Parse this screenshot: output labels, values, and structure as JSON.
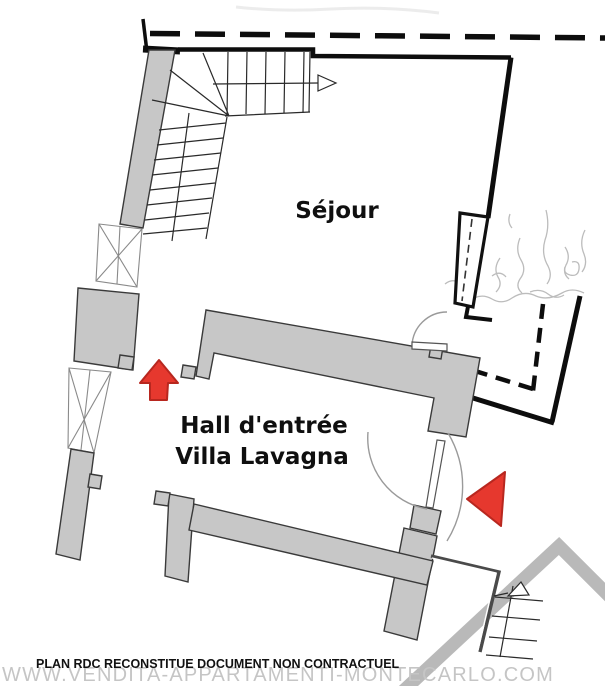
{
  "plan": {
    "rooms": {
      "sejour": {
        "label": "Séjour"
      },
      "hall": {
        "label_line1": "Hall d'entrée",
        "label_line2": "Villa Lavagna"
      }
    },
    "caption": "PLAN RDC RECONSTITUE  DOCUMENT NON CONTRACTUEL",
    "watermark": "WWW.VENDITA-APPARTAMENTI-MONTECARLO.COM",
    "colors": {
      "wall_fill": "#c7c7c7",
      "wall_outline": "#3a3a3a",
      "line_black": "#0d0d0d",
      "arrow_red_fill": "#e6382e",
      "arrow_red_stroke": "#b8271f",
      "watermark_gray": "#c5c5c5",
      "roof_gray": "#b9b9b9",
      "sketch_gray": "#a6a6a6"
    }
  }
}
